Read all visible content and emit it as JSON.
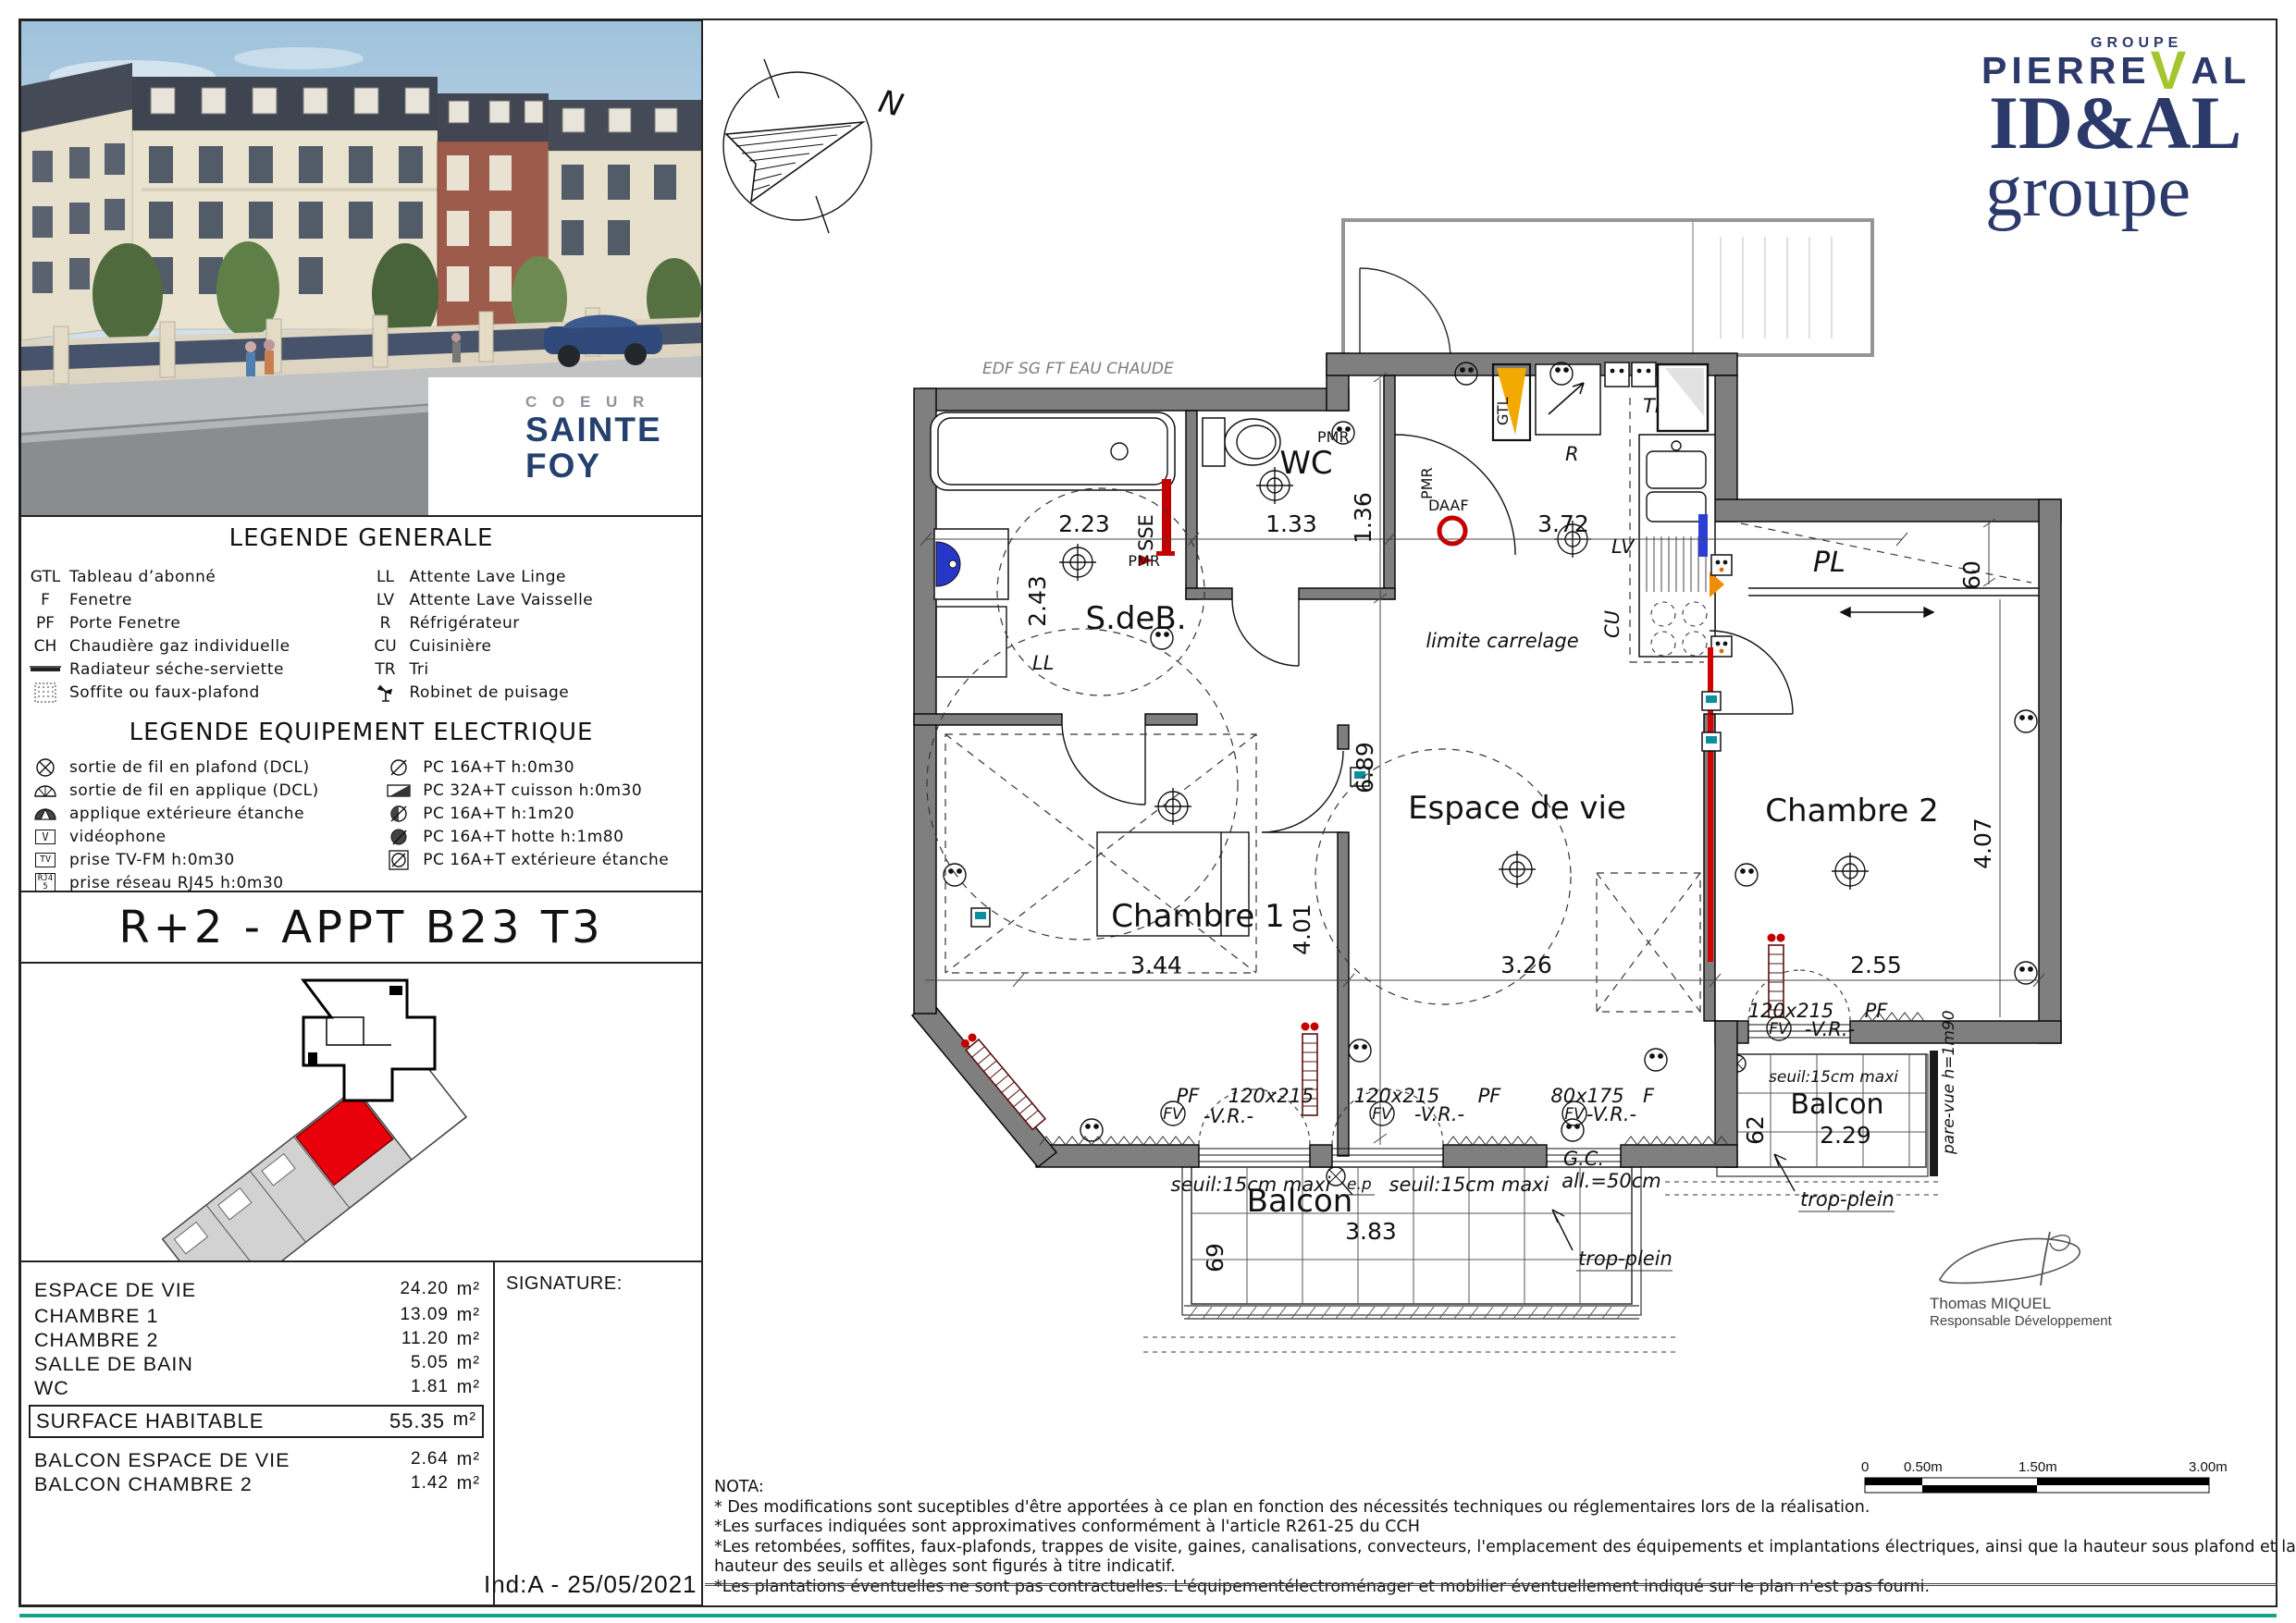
{
  "brand": {
    "coeur": "C O E U R",
    "line1": "SAINTE",
    "line2": "FOY"
  },
  "logos": {
    "groupe": "GROUPE",
    "p_left": "PIERRE",
    "p_v": "V",
    "p_right": "AL",
    "idal": "ID&AL",
    "idal_sub": "groupe"
  },
  "legend_general": {
    "title": "LEGENDE GENERALE",
    "left": [
      {
        "abbr": "GTL",
        "label": "Tableau d’abonné"
      },
      {
        "abbr": "F",
        "label": "Fenetre"
      },
      {
        "abbr": "PF",
        "label": "Porte Fenetre"
      },
      {
        "abbr": "CH",
        "label": "Chaudière gaz individuelle"
      },
      {
        "abbr": "",
        "label": "Radiateur séche-serviette"
      },
      {
        "abbr": "",
        "label": "Soffite ou faux-plafond"
      }
    ],
    "right": [
      {
        "abbr": "LL",
        "label": "Attente Lave Linge"
      },
      {
        "abbr": "LV",
        "label": "Attente Lave Vaisselle"
      },
      {
        "abbr": "R",
        "label": "Réfrigérateur"
      },
      {
        "abbr": "CU",
        "label": "Cuisinière"
      },
      {
        "abbr": "TR",
        "label": "Tri"
      },
      {
        "abbr": "",
        "label": "Robinet de puisage"
      }
    ]
  },
  "legend_electric": {
    "title": "LEGENDE EQUIPEMENT ELECTRIQUE",
    "left": [
      {
        "label": "sortie de fil en plafond (DCL)"
      },
      {
        "label": "sortie de fil en applique (DCL)"
      },
      {
        "label": "applique extérieure étanche"
      },
      {
        "label": "vidéophone",
        "sym": "V"
      },
      {
        "label": "prise TV-FM h:0m30",
        "sym": "TV"
      },
      {
        "label": "prise réseau RJ45 h:0m30",
        "sym": "RJ45"
      }
    ],
    "right": [
      {
        "label": "PC 16A+T h:0m30"
      },
      {
        "label": "PC 32A+T cuisson h:0m30"
      },
      {
        "label": "PC 16A+T h:1m20"
      },
      {
        "label": "PC 16A+T hotte h:1m80"
      },
      {
        "label": "PC 16A+T extérieure étanche"
      }
    ]
  },
  "title_block": {
    "title": "R+2 - APPT B23 T3"
  },
  "areas": {
    "rows": [
      {
        "label": "ESPACE DE VIE",
        "value": "24.20",
        "unit": "m²"
      },
      {
        "label": "CHAMBRE 1",
        "value": "13.09",
        "unit": "m²"
      },
      {
        "label": "CHAMBRE 2",
        "value": "11.20",
        "unit": "m²"
      },
      {
        "label": "SALLE DE BAIN",
        "value": "5.05",
        "unit": "m²"
      },
      {
        "label": "WC",
        "value": "1.81",
        "unit": "m²"
      }
    ],
    "total": {
      "label": "SURFACE HABITABLE",
      "value": "55.35",
      "unit": "m²"
    },
    "balconies": [
      {
        "label": "BALCON ESPACE DE VIE",
        "value": "2.64",
        "unit": "m²"
      },
      {
        "label": "BALCON CHAMBRE 2",
        "value": "1.42",
        "unit": "m²"
      }
    ],
    "signature_label": "SIGNATURE:",
    "index_label": "Ind:A - 25/05/2021"
  },
  "plan": {
    "north": "N",
    "rooms": {
      "sdeb": "S.deB.",
      "wc": "WC",
      "espace": "Espace de vie",
      "ch1": "Chambre 1",
      "ch2": "Chambre 2",
      "pl": "PL",
      "balcon": "Balcon",
      "balcon2": "Balcon"
    },
    "dims": {
      "d223": "2.23",
      "d243": "2.43",
      "d133": "1.33",
      "d136": "1.36",
      "d372": "3.72",
      "d689": "6.89",
      "d401": "4.01",
      "d344": "3.44",
      "d326": "3.26",
      "d255": "2.55",
      "d407": "4.07",
      "d60": "60",
      "d69": "69",
      "d383": "3.83",
      "d62": "62",
      "d229": "2.29"
    },
    "ann": {
      "pmr": "PMR",
      "sse": "SSE",
      "daaf": "DAAF",
      "gtl": "GTL",
      "tri": "TRI",
      "r": "R",
      "lv": "LV",
      "cu": "CU",
      "limite": "limite  carrelage",
      "w120": "120x215",
      "w80": "80x175",
      "pf": "PF",
      "f": "F",
      "vr": "-V.R.-",
      "fv": "FV",
      "seuil": "seuil:15cm  maxi",
      "gc": "G.C.",
      "all50": "all.=50cm",
      "trop": "trop-plein",
      "pare": "pare-vue  h=1m90",
      "ep": "e.p",
      "ghost": "EDF    SG    FT    EAU   CHAUDE",
      "ll": "LL"
    }
  },
  "nota": {
    "title": "NOTA:",
    "lines": [
      "* Des modifications sont suceptibles d'être apportées à ce plan en fonction des nécessités techniques ou réglementaires lors de la réalisation.",
      "*Les surfaces indiquées sont approximatives conformément à l'article R261-25 du CCH",
      "*Les retombées, soffites, faux-plafonds, trappes de visite, gaines, canalisations, convecteurs, l'emplacement des équipements et implantations électriques, ainsi que la hauteur sous plafond et la",
      " hauteur des seuils et allèges sont figurés à titre indicatif.",
      "*Les plantations éventuelles ne sont pas contractuelles. L'équipementélectroménager et mobilier éventuellement indiqué sur le plan n'est pas fourni."
    ]
  },
  "scalebar": {
    "l0": "0",
    "l1": "0.50m",
    "l2": "1.50m",
    "l3": "3.00m"
  },
  "approver": {
    "name": "Thomas MIQUEL",
    "role": "Responsable Développement"
  }
}
